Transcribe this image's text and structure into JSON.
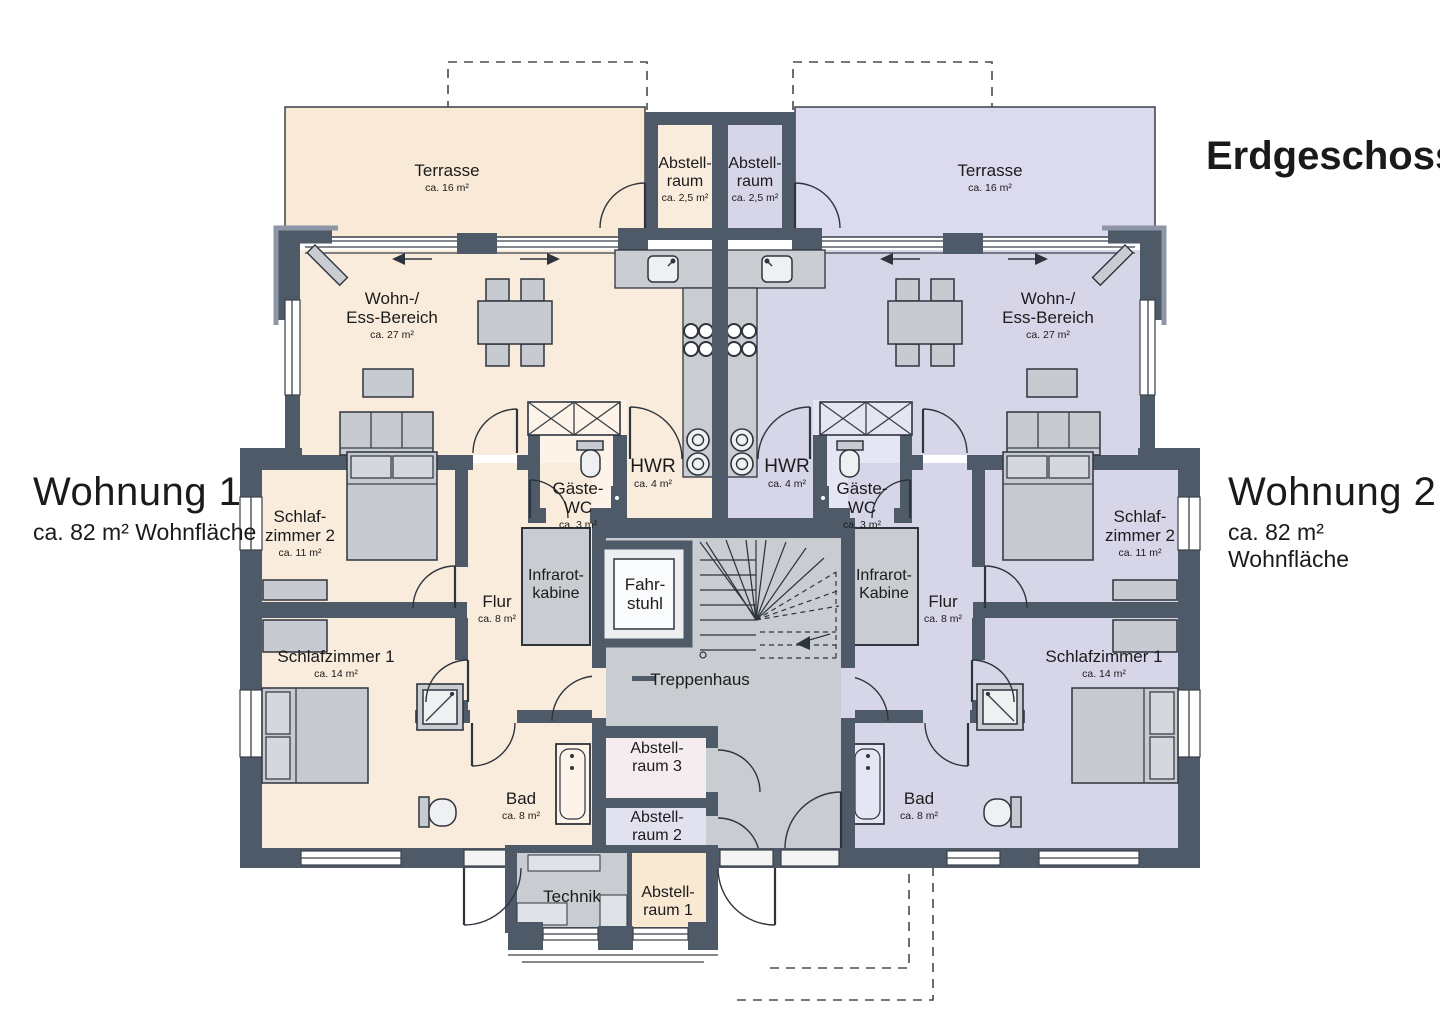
{
  "title": "Erdgeschoss",
  "apartments": [
    {
      "name": "Wohnung 1",
      "area": "ca. 82 m² Wohnfläche",
      "side": "left",
      "fill": "#f9ecdc"
    },
    {
      "name": "Wohnung 2",
      "area": "ca. 82 m² Wohnfläche",
      "side": "right",
      "fill": "#d7d6e9"
    }
  ],
  "colors": {
    "wall": "#4e5a68",
    "outline": "#2e343c",
    "wohnung1_fill": "#f9ecdc",
    "wohnung2_fill": "#d7d6e9",
    "common_fill": "#c9cdd2",
    "abstellraum3_fill": "#f5ecef",
    "abstellraum2_fill": "#e2e1f0",
    "abstellraum1_fill": "#f9e8d2"
  },
  "labels": [
    {
      "name": "terrasse-1",
      "lines": [
        "Terrasse"
      ],
      "sub": "ca. 16 m²",
      "x": 447,
      "y": 176,
      "s": 17
    },
    {
      "name": "abstellraum-top-1",
      "lines": [
        "Abstell-",
        "raum"
      ],
      "sub": "ca. 2,5 m²",
      "x": 685,
      "y": 168,
      "s": 16
    },
    {
      "name": "abstellraum-top-2",
      "lines": [
        "Abstell-",
        "raum"
      ],
      "sub": "ca. 2,5 m²",
      "x": 755,
      "y": 168,
      "s": 16
    },
    {
      "name": "terrasse-2",
      "lines": [
        "Terrasse"
      ],
      "sub": "ca. 16 m²",
      "x": 990,
      "y": 176,
      "s": 17
    },
    {
      "name": "wohnbereich-1",
      "lines": [
        "Wohn-/",
        "Ess-Bereich"
      ],
      "sub": "ca. 27 m²",
      "x": 392,
      "y": 304,
      "s": 17
    },
    {
      "name": "wohnbereich-2",
      "lines": [
        "Wohn-/",
        "Ess-Bereich"
      ],
      "sub": "ca. 27 m²",
      "x": 1048,
      "y": 304,
      "s": 17
    },
    {
      "name": "hwr-1",
      "lines": [
        "HWR"
      ],
      "sub": "ca. 4 m²",
      "x": 653,
      "y": 472,
      "s": 19
    },
    {
      "name": "hwr-2",
      "lines": [
        "HWR"
      ],
      "sub": "ca. 4 m²",
      "x": 787,
      "y": 472,
      "s": 19
    },
    {
      "name": "gaeste-wc-1",
      "lines": [
        "Gäste-",
        "WC"
      ],
      "sub": "ca. 3 m²",
      "x": 578,
      "y": 494,
      "s": 17
    },
    {
      "name": "gaeste-wc-2",
      "lines": [
        "Gäste-",
        "WC"
      ],
      "sub": "ca. 3 m²",
      "x": 862,
      "y": 494,
      "s": 17
    },
    {
      "name": "schlafzimmer2-1",
      "lines": [
        "Schlaf-",
        "zimmer 2"
      ],
      "sub": "ca. 11 m²",
      "x": 300,
      "y": 522,
      "s": 17
    },
    {
      "name": "schlafzimmer2-2",
      "lines": [
        "Schlaf-",
        "zimmer 2"
      ],
      "sub": "ca. 11 m²",
      "x": 1140,
      "y": 522,
      "s": 17
    },
    {
      "name": "infrarotkabine-1",
      "lines": [
        "Infrarot-",
        "kabine"
      ],
      "x": 556,
      "y": 580,
      "s": 16
    },
    {
      "name": "infrarotkabine-2",
      "lines": [
        "Infrarot-",
        "Kabine"
      ],
      "x": 884,
      "y": 580,
      "s": 16
    },
    {
      "name": "fahrstuhl",
      "lines": [
        "Fahr-",
        "stuhl"
      ],
      "x": 645,
      "y": 590,
      "s": 17
    },
    {
      "name": "flur-1",
      "lines": [
        "Flur"
      ],
      "sub": "ca. 8 m²",
      "x": 497,
      "y": 607,
      "s": 17
    },
    {
      "name": "flur-2",
      "lines": [
        "Flur"
      ],
      "sub": "ca. 8 m²",
      "x": 943,
      "y": 607,
      "s": 17
    },
    {
      "name": "schlafzimmer1-1",
      "lines": [
        "Schlafzimmer 1"
      ],
      "sub": "ca. 14 m²",
      "x": 336,
      "y": 662,
      "s": 17
    },
    {
      "name": "schlafzimmer1-2",
      "lines": [
        "Schlafzimmer 1"
      ],
      "sub": "ca. 14 m²",
      "x": 1104,
      "y": 662,
      "s": 17
    },
    {
      "name": "treppenhaus",
      "lines": [
        "Treppenhaus"
      ],
      "x": 700,
      "y": 685,
      "s": 17
    },
    {
      "name": "abstellraum-3",
      "lines": [
        "Abstell-",
        "raum 3"
      ],
      "x": 657,
      "y": 753,
      "s": 16
    },
    {
      "name": "abstellraum-2",
      "lines": [
        "Abstell-",
        "raum 2"
      ],
      "x": 657,
      "y": 822,
      "s": 16
    },
    {
      "name": "bad-1",
      "lines": [
        "Bad"
      ],
      "sub": "ca. 8 m²",
      "x": 521,
      "y": 804,
      "s": 17
    },
    {
      "name": "bad-2",
      "lines": [
        "Bad"
      ],
      "sub": "ca. 8 m²",
      "x": 919,
      "y": 804,
      "s": 17
    },
    {
      "name": "technik",
      "lines": [
        "Technik"
      ],
      "x": 572,
      "y": 902,
      "s": 17
    },
    {
      "name": "abstellraum-1",
      "lines": [
        "Abstell-",
        "raum 1"
      ],
      "x": 668,
      "y": 897,
      "s": 16
    }
  ]
}
